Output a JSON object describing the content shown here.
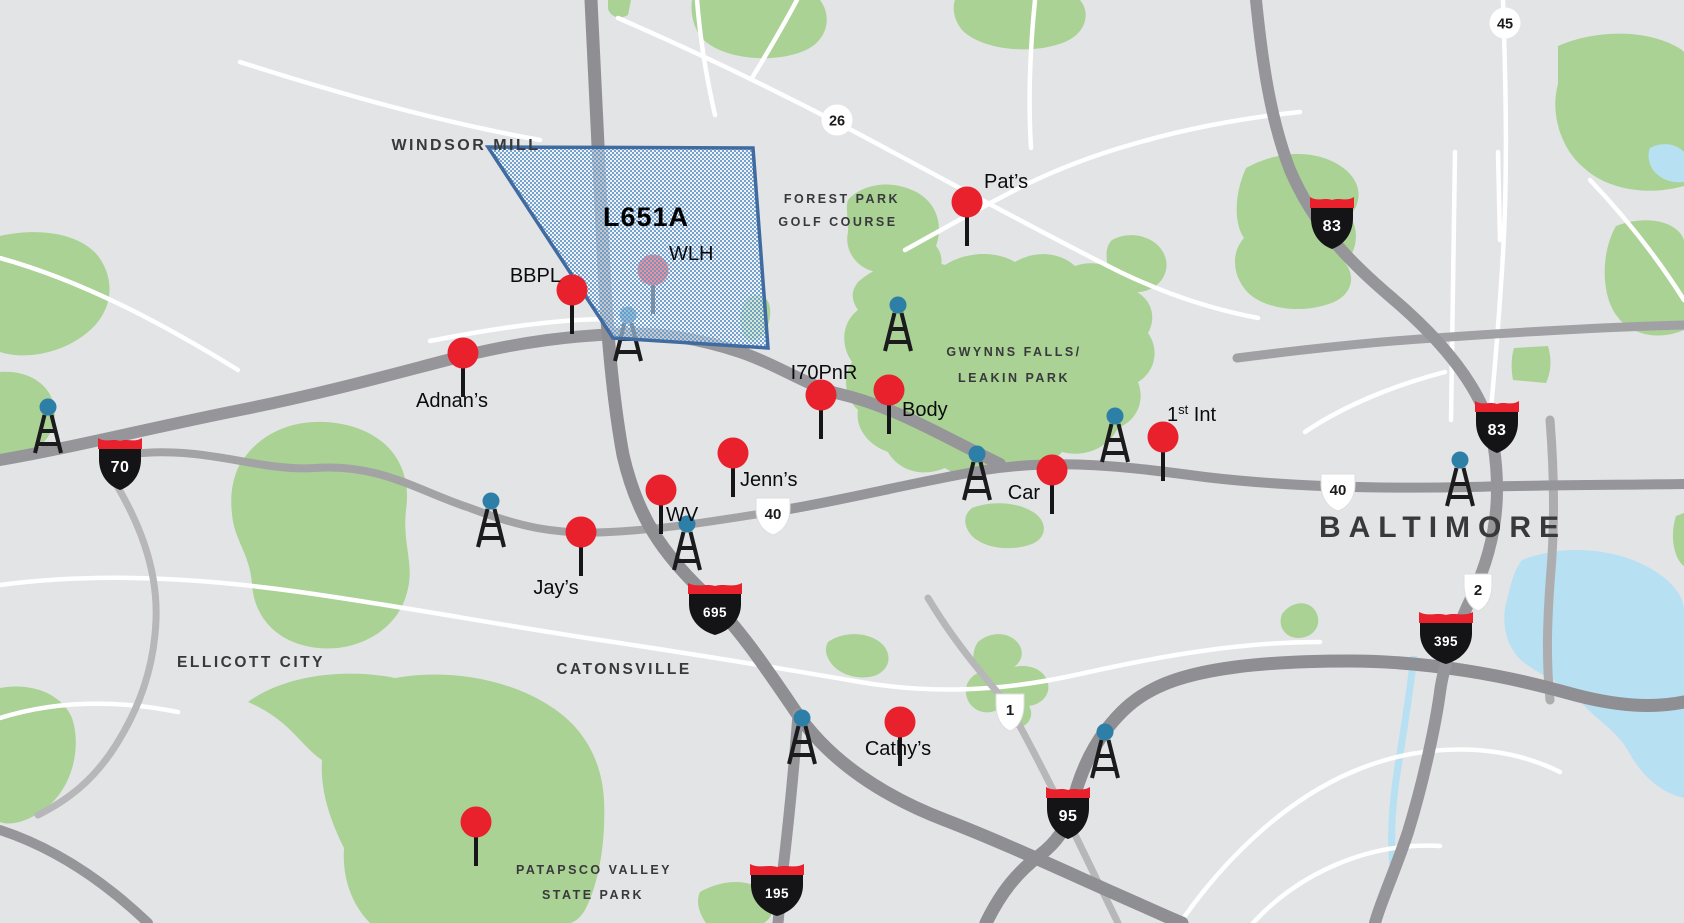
{
  "map": {
    "colors": {
      "background": "#e3e4e6",
      "park": "#a9d294",
      "water": "#b7e0f2",
      "road_major": "#96969a",
      "road_dark": "#8f8f93",
      "road_light": "#b7b7ba",
      "road_white": "#ffffff",
      "pin": "#e8212d",
      "pin_stem": "#161618",
      "tower_dot": "#2d7fa8",
      "tower_frame": "#1b1b1d",
      "interstate_shield": "#141416",
      "interstate_band": "#e8212d",
      "coverage_fill": "#5e95ca",
      "coverage_stroke": "#3f6ba1"
    },
    "coverage": {
      "label": "L651A",
      "points": "488,147 753,148 768,348 613,338",
      "label_x": 646,
      "label_y": 226
    },
    "pins": [
      {
        "name": "pats",
        "label": "Pat’s",
        "x": 967,
        "y": 202,
        "label_x": 984,
        "label_y": 188,
        "anchor": "start"
      },
      {
        "name": "wlh",
        "label": "WLH",
        "x": 653,
        "y": 270,
        "label_x": 669,
        "label_y": 260,
        "anchor": "start",
        "under_coverage": true
      },
      {
        "name": "bbpl",
        "label": "BBPL",
        "x": 572,
        "y": 290,
        "label_x": 561,
        "label_y": 282,
        "anchor": "end"
      },
      {
        "name": "adnans",
        "label": "Adnan’s",
        "x": 463,
        "y": 353,
        "label_x": 452,
        "label_y": 407,
        "anchor": "middle"
      },
      {
        "name": "i70pnr",
        "label": "I70PnR",
        "x": 821,
        "y": 395,
        "label_x": 824,
        "label_y": 379,
        "anchor": "middle"
      },
      {
        "name": "body",
        "label": "Body",
        "x": 889,
        "y": 390,
        "label_x": 902,
        "label_y": 416,
        "anchor": "start"
      },
      {
        "name": "jenns",
        "label": "Jenn’s",
        "x": 733,
        "y": 453,
        "label_x": 740,
        "label_y": 486,
        "anchor": "start"
      },
      {
        "name": "wv",
        "label": "WV",
        "x": 661,
        "y": 490,
        "label_x": 666,
        "label_y": 521,
        "anchor": "start"
      },
      {
        "name": "jays",
        "label": "Jay’s",
        "x": 581,
        "y": 532,
        "label_x": 556,
        "label_y": 594,
        "anchor": "middle"
      },
      {
        "name": "car",
        "label": "Car",
        "x": 1052,
        "y": 470,
        "label_x": 1040,
        "label_y": 499,
        "anchor": "end"
      },
      {
        "name": "first-int",
        "label": "1st Int",
        "label_parts": {
          "base": "1",
          "sup": "st",
          "rest": " Int"
        },
        "x": 1163,
        "y": 437,
        "label_x": 1167,
        "label_y": 421,
        "anchor": "start"
      },
      {
        "name": "cathys",
        "label": "Cathy’s",
        "x": 900,
        "y": 722,
        "label_x": 898,
        "label_y": 755,
        "anchor": "middle"
      },
      {
        "name": "patapsco-pin",
        "label": "",
        "x": 476,
        "y": 822
      }
    ],
    "towers": [
      {
        "x": 48,
        "y": 408
      },
      {
        "x": 628,
        "y": 316,
        "under_coverage": true
      },
      {
        "x": 898,
        "y": 306
      },
      {
        "x": 977,
        "y": 455
      },
      {
        "x": 1115,
        "y": 417
      },
      {
        "x": 687,
        "y": 525
      },
      {
        "x": 491,
        "y": 502
      },
      {
        "x": 802,
        "y": 719
      },
      {
        "x": 1105,
        "y": 733
      },
      {
        "x": 1460,
        "y": 461
      }
    ],
    "shields": [
      {
        "type": "interstate",
        "label": "70",
        "x": 120,
        "y": 463
      },
      {
        "type": "interstate",
        "label": "83",
        "x": 1332,
        "y": 222
      },
      {
        "type": "interstate",
        "label": "83",
        "x": 1497,
        "y": 426
      },
      {
        "type": "interstate",
        "label": "695",
        "x": 715,
        "y": 608
      },
      {
        "type": "interstate",
        "label": "95",
        "x": 1068,
        "y": 812
      },
      {
        "type": "interstate",
        "label": "195",
        "x": 777,
        "y": 889
      },
      {
        "type": "interstate",
        "label": "395",
        "x": 1446,
        "y": 637
      },
      {
        "type": "us",
        "label": "40",
        "x": 773,
        "y": 512
      },
      {
        "type": "us",
        "label": "40",
        "x": 1338,
        "y": 488
      },
      {
        "type": "us",
        "label": "1",
        "x": 1010,
        "y": 708
      },
      {
        "type": "us",
        "label": "2",
        "x": 1478,
        "y": 588
      },
      {
        "type": "circle",
        "label": "26",
        "x": 837,
        "y": 120
      },
      {
        "type": "circle",
        "label": "45",
        "x": 1505,
        "y": 23
      }
    ],
    "place_labels": [
      {
        "text": "WINDSOR MILL",
        "x": 466,
        "y": 150,
        "size": 16,
        "spacing": 2.5
      },
      {
        "text": "FOREST PARK",
        "x": 842,
        "y": 203,
        "size": 12.5,
        "spacing": 2.5
      },
      {
        "text": "GOLF COURSE",
        "x": 838,
        "y": 226,
        "size": 12.5,
        "spacing": 2.5
      },
      {
        "text": "GWYNNS FALLS/",
        "x": 1014,
        "y": 356,
        "size": 12.5,
        "spacing": 2.5
      },
      {
        "text": "LEAKIN PARK",
        "x": 1014,
        "y": 382,
        "size": 12.5,
        "spacing": 2.5
      },
      {
        "text": "ELLICOTT CITY",
        "x": 251,
        "y": 667,
        "size": 15.5,
        "spacing": 2.5
      },
      {
        "text": "CATONSVILLE",
        "x": 624,
        "y": 674,
        "size": 15.5,
        "spacing": 2.5
      },
      {
        "text": "PATAPSCO VALLEY",
        "x": 594,
        "y": 874,
        "size": 12.5,
        "spacing": 2.5
      },
      {
        "text": "STATE PARK",
        "x": 593,
        "y": 899,
        "size": 12.5,
        "spacing": 2.5
      },
      {
        "text": "BALTIMORE",
        "x": 1443,
        "y": 537,
        "size": 30,
        "spacing": 8,
        "weight": 600,
        "color": "#2c2c2e"
      }
    ]
  }
}
